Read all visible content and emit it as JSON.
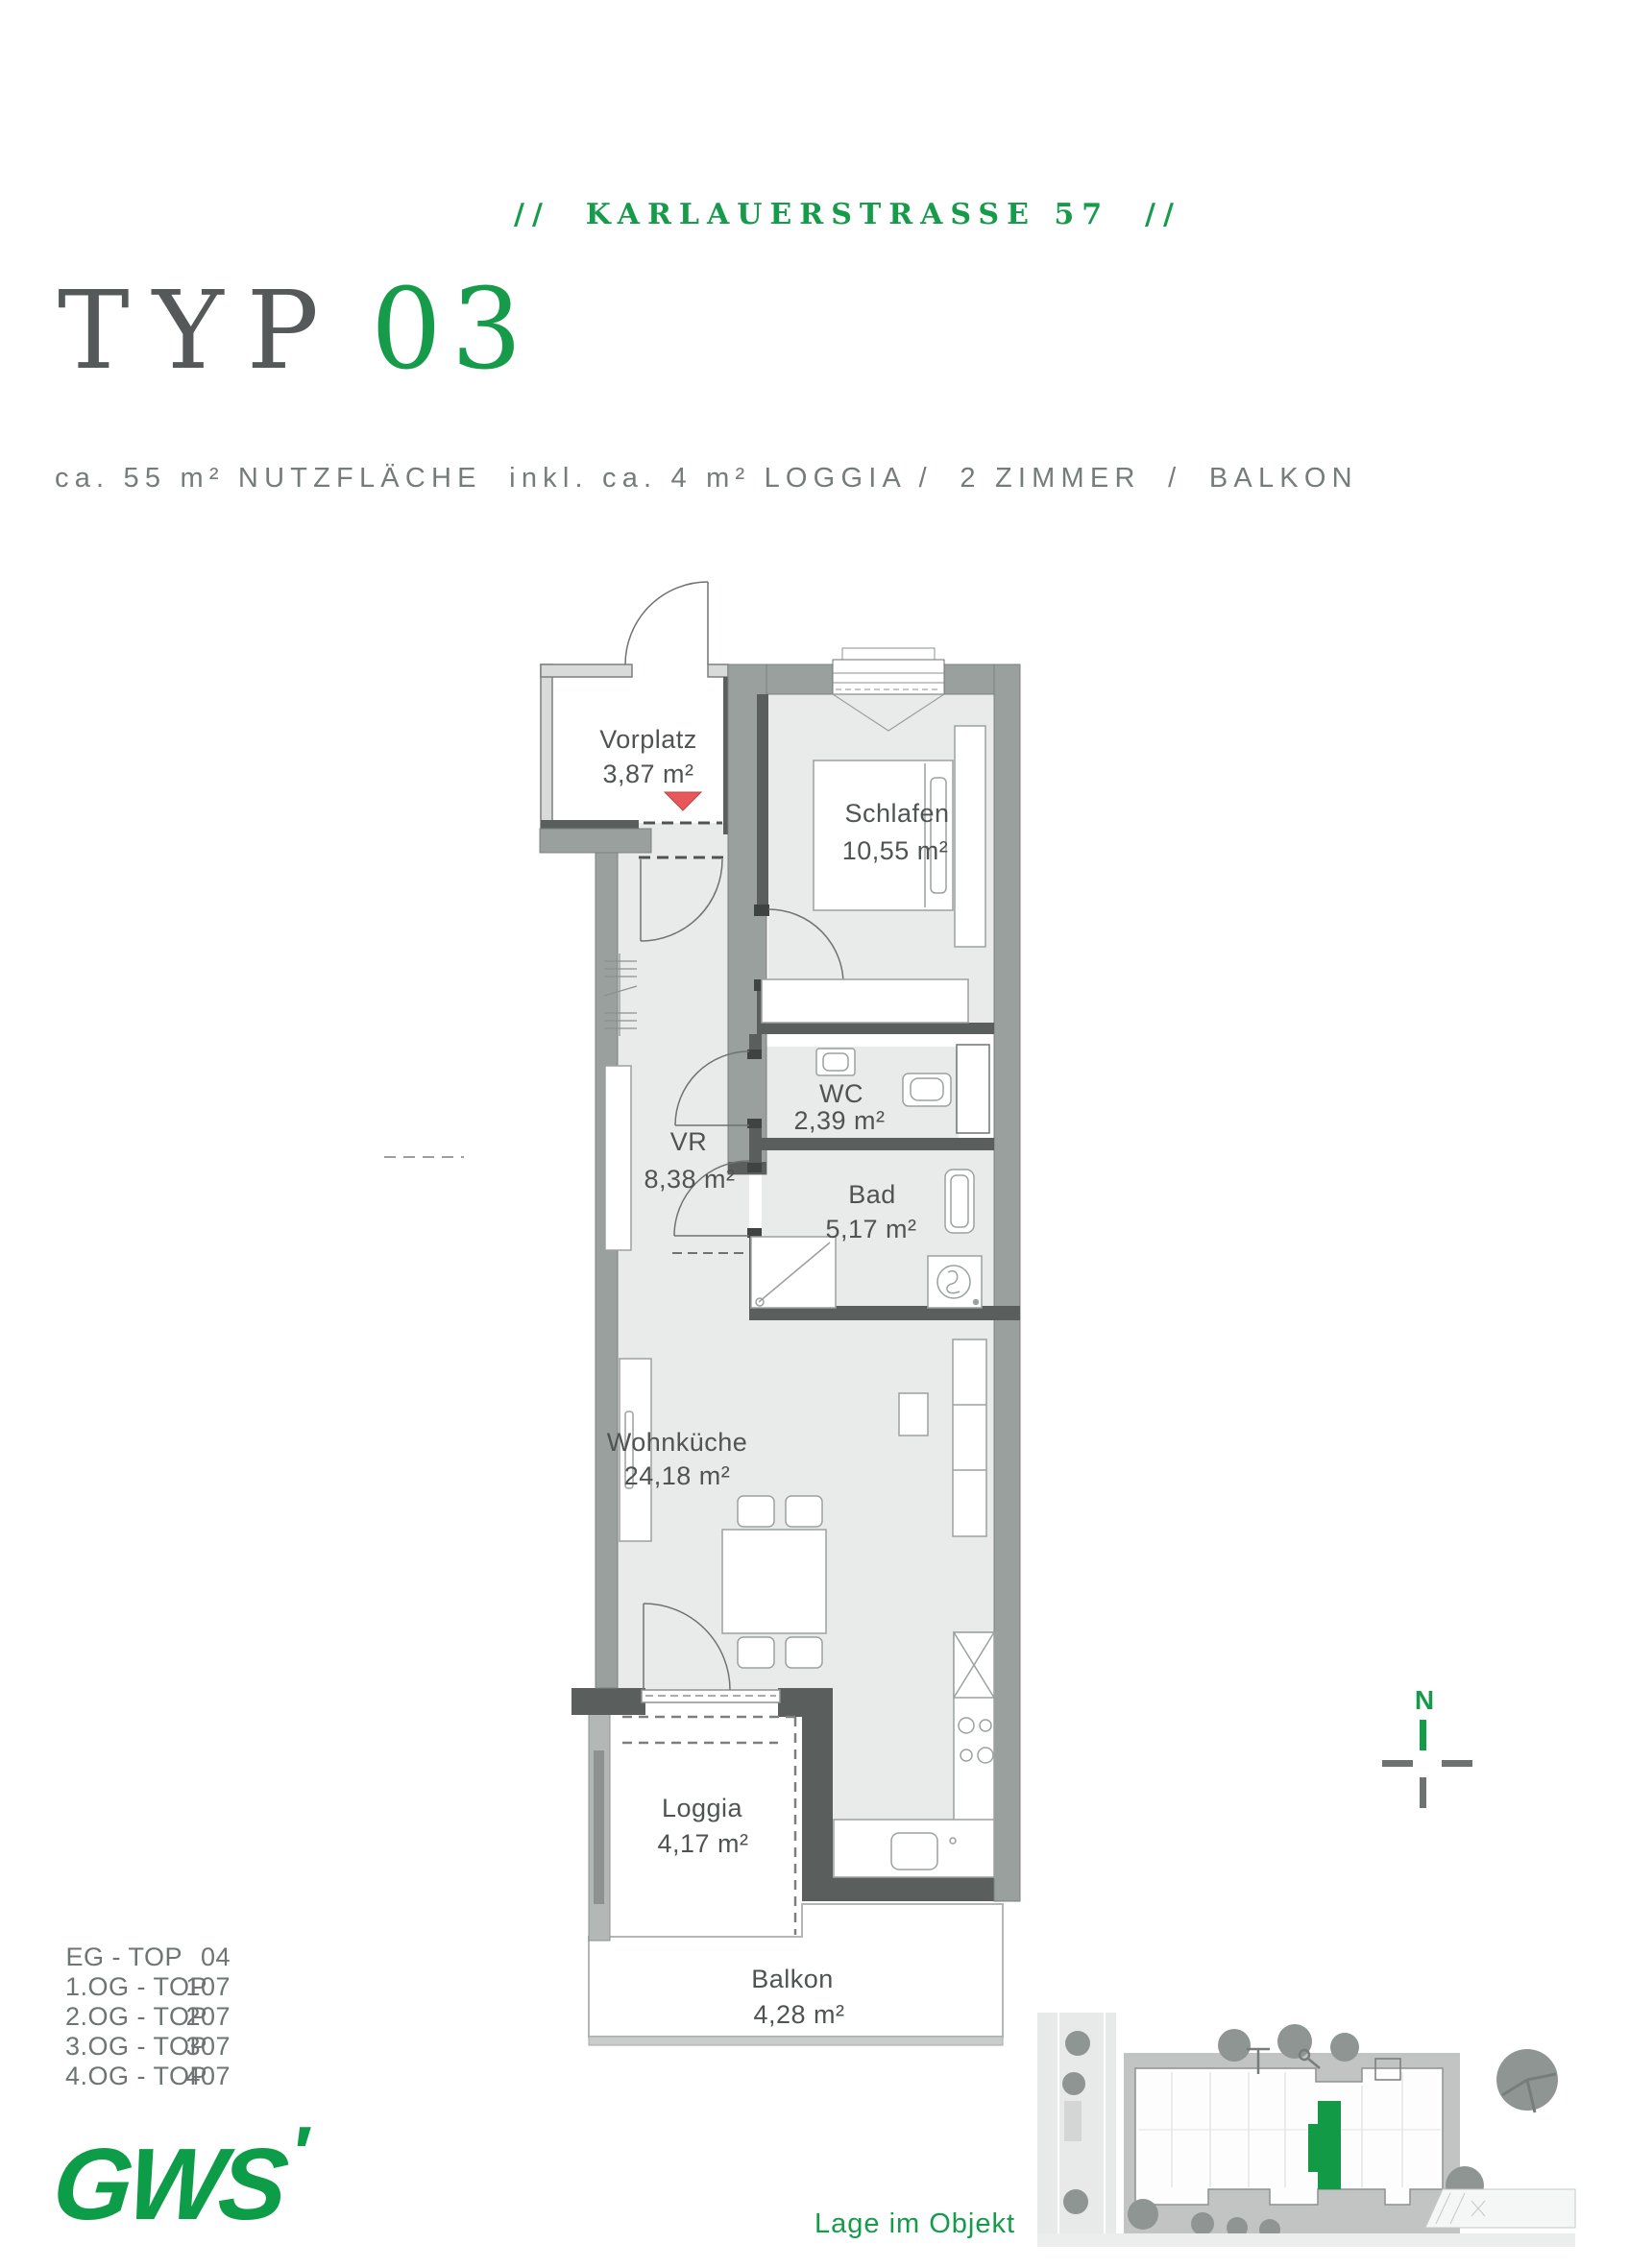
{
  "colors": {
    "green": "#169b4b",
    "red_marker": "#e8585a",
    "wall_dark": "#5a5f5e",
    "wall_gray": "#9aa09d",
    "floor_gray": "#e9ebea",
    "text_gray": "#6e7473"
  },
  "header": {
    "project": "//  KARLAUERSTRASSE 57  //"
  },
  "title": {
    "prefix": "TYP",
    "number": "03"
  },
  "subtitle": "ca. 55 m² NUTZFLÄCHE  inkl. ca. 4 m² LOGGIA /  2 ZIMMER  /  BALKON",
  "plan": {
    "rooms": [
      {
        "name": "Vorplatz",
        "area": "3,87 m²"
      },
      {
        "name": "Schlafen",
        "area": "10,55 m²"
      },
      {
        "name": "VR",
        "area": "8,38 m²"
      },
      {
        "name": "WC",
        "area": "2,39 m²"
      },
      {
        "name": "Bad",
        "area": "5,17 m²"
      },
      {
        "name": "Wohnküche",
        "area": "24,18 m²"
      },
      {
        "name": "Loggia",
        "area": "4,17 m²"
      },
      {
        "name": "Balkon",
        "area": "4,28 m²"
      }
    ]
  },
  "units": {
    "rows": [
      {
        "floor": "EG - TOP",
        "number": "04"
      },
      {
        "floor": "1.OG - TOP",
        "number": "107"
      },
      {
        "floor": "2.OG - TOP",
        "number": "207"
      },
      {
        "floor": "3.OG - TOP",
        "number": "307"
      },
      {
        "floor": "4.OG - TOP",
        "number": "407"
      }
    ]
  },
  "compass": {
    "north": "N"
  },
  "logo": {
    "text": "GWS",
    "mark": "′"
  },
  "site": {
    "caption": "Lage im Objekt"
  }
}
